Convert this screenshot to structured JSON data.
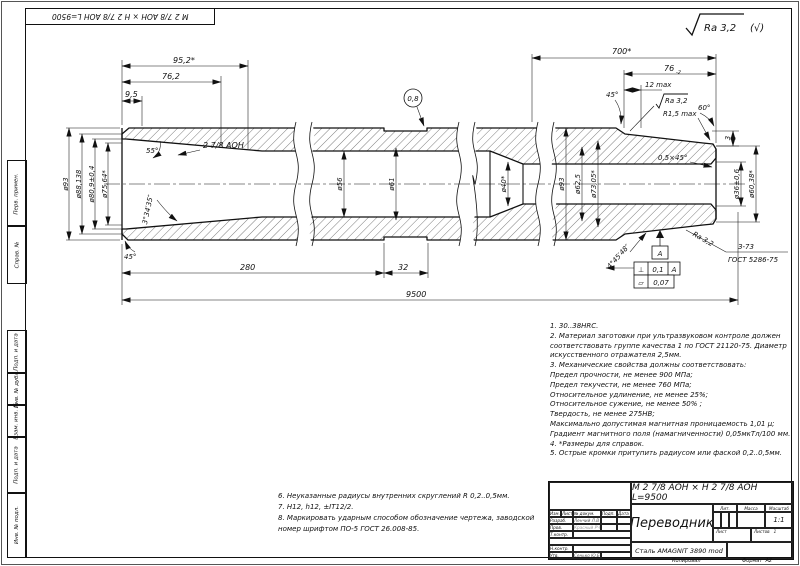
{
  "sheet": {
    "top_left_stamp": "М 2 7/8 АОН × Н 2 7/8 АОН L=9500",
    "roughness_general": "Ra 3,2",
    "roughness_suffix": "(√)",
    "copied_label": "Копировал",
    "format_label": "Формат",
    "format_value": "А2",
    "side_labels": [
      "Перв. примен.",
      "Справ. №",
      "Подп. и дата",
      "Инв. № дубл.",
      "Взам. инв. №",
      "Подп. и дата",
      "Инв. № подл."
    ]
  },
  "dims": {
    "len95": "95,2*",
    "len76l": "76,2",
    "len9_5": "9,5",
    "ang55": "55°",
    "thread_left": "2 7/8 АОН",
    "ang334": "3°34′35″",
    "ang45bl": "45°",
    "dia93_left": "ø93",
    "dia88": "ø88,138",
    "dia80_9": "ø80,9±0,4",
    "dia75_64": "ø75,64*",
    "dia56": "ø56",
    "dia61": "ø61",
    "balloon": "0,8",
    "dia40": "ø40*",
    "dia93_right": "ø93",
    "dia62_5": "ø62,5",
    "dia73_05": "ø73,05*",
    "len700": "700*",
    "len76r": "76",
    "len76r_tol": "-2",
    "len12max": "12 max",
    "ang45r": "45°",
    "ra32_top": "Ra 3,2",
    "r15max": "R1,5 max",
    "ang60": "60°",
    "len3": "3",
    "cham05": "0,5×45°",
    "dia36": "ø36±0,6",
    "dia60_38": "ø60,38*",
    "ang445": "4°45′48″",
    "datum_a": "А",
    "tol_perp_sym": "⊥",
    "tol_perp": "0,1",
    "tol_perp_ref": "А",
    "tol_flat_sym": "▱",
    "tol_flat": "0,07",
    "ra32_thread": "Ra 3,2",
    "thread_right": "З-73",
    "thread_right_gost": "ГОСТ 5286-75",
    "len280": "280",
    "len32": "32",
    "len9500": "9500"
  },
  "notes": {
    "right": [
      "1. 30..38HRC.",
      "2. Материал заготовки при ультразвуковом контроле должен",
      "соответствовать группе качества 1 по ГОСТ 21120-75. Диаметр",
      "искусственного отражателя 2,5мм.",
      "3. Механические свойства должны соответствовать:",
      "Предел прочности, не менее 900 МПа;",
      "Предел текучести, не менее 760 МПа;",
      "Относительное удлинение, не менее 25%;",
      "Относительное сужение, не менее 50% ;",
      "Твердость, не менее 275НВ;",
      "Максимально допустимая магнитная проницаемость  1,01 μ;",
      "Градиент магнитного поля (намагниченности)  0,05мкТл/100 мм.",
      "4.  *Размеры для справок.",
      "5. Острые кромки притупить радиусом или фаской 0,2..0,5мм."
    ],
    "bottom": [
      "6. Неуказанные радиусы внутренних скруглений R 0,2..0,5мм.",
      "7. H12, h12, ±IT12/2.",
      "8. Маркировать ударным способом обозначение чертежа, заводской",
      "номер шрифтом ПО-5 ГОСТ 26.008-85."
    ]
  },
  "title_block": {
    "designation": "М 2 7/8 АОН × Н 2 7/8 АОН L=9500",
    "name": "Переводник",
    "material": "Сталь AMAGNIT 3890 mod",
    "col_izm": "Изм.",
    "col_list": "Лист",
    "col_doc": "№ докум.",
    "col_sign": "Подп.",
    "col_date": "Дата",
    "row_razrab": "Разраб.",
    "row_razrab_name": "Ленчий Л.В",
    "row_prov": "Пров.",
    "row_prov_name": "Красный РЧ",
    "row_tkontr": "Т.контр.",
    "row_nkontr": "Н.контр.",
    "row_utv": "Утв.",
    "row_utv_name": "Сенько Ю.Е",
    "lit_label": "Лит.",
    "mass_label": "Масса",
    "scale_label": "Масштаб",
    "scale_value": "1:1",
    "sheet_label": "Лист",
    "sheets_label": "Листов",
    "sheets_value": "1"
  },
  "colors": {
    "line": "#111111",
    "paper": "#ffffff"
  }
}
